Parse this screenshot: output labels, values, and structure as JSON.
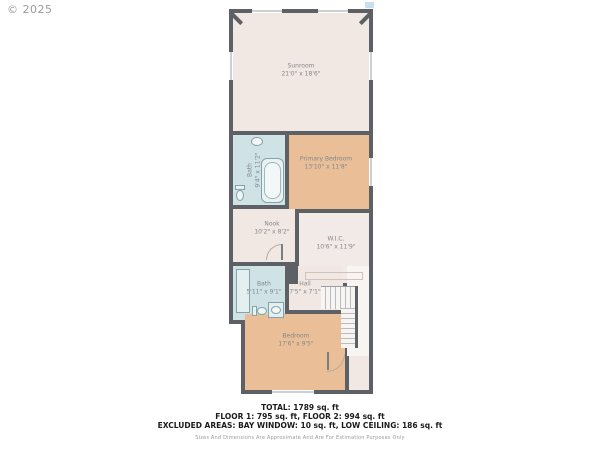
{
  "copyright": "© 2025",
  "floorplan": {
    "rooms": [
      {
        "name": "Sunroom",
        "dims": "21'0\" x 18'6\""
      },
      {
        "name": "Bath",
        "dims": "9'4\" x 11'2\""
      },
      {
        "name": "Primary Bedroom",
        "dims": "13'10\" x 11'8\""
      },
      {
        "name": "Nook",
        "dims": "10'2\" x 8'2\""
      },
      {
        "name": "W.I.C.",
        "dims": "10'6\" x 11'9\""
      },
      {
        "name": "Bath",
        "dims": "5'11\" x 9'1\""
      },
      {
        "name": "Hall",
        "dims": "7'5\" x 7'1\""
      },
      {
        "name": "Bedroom",
        "dims": "17'6\" x 9'5\""
      }
    ],
    "icons": [
      "bathtub-icon",
      "toilet-icon",
      "sink-icon",
      "shower-icon",
      "stairs-icon",
      "door-swing-icon"
    ]
  },
  "summary": {
    "total": "TOTAL: 1789 sq. ft",
    "floors": "FLOOR 1: 795 sq. ft, FLOOR 2: 994 sq. ft",
    "excluded": "EXCLUDED AREAS: BAY WINDOW: 10 sq. ft, LOW CEILING: 186 sq. ft",
    "disclaimer": "Sizes And Dimensions Are Approximate And Are For Estimation Purposes Only"
  },
  "colors": {
    "wall": "#5d6166",
    "room_pink": "#f2e8e3",
    "room_tan": "#eabf97",
    "room_blue": "#cfe2e5",
    "label_text": "#82878c"
  }
}
